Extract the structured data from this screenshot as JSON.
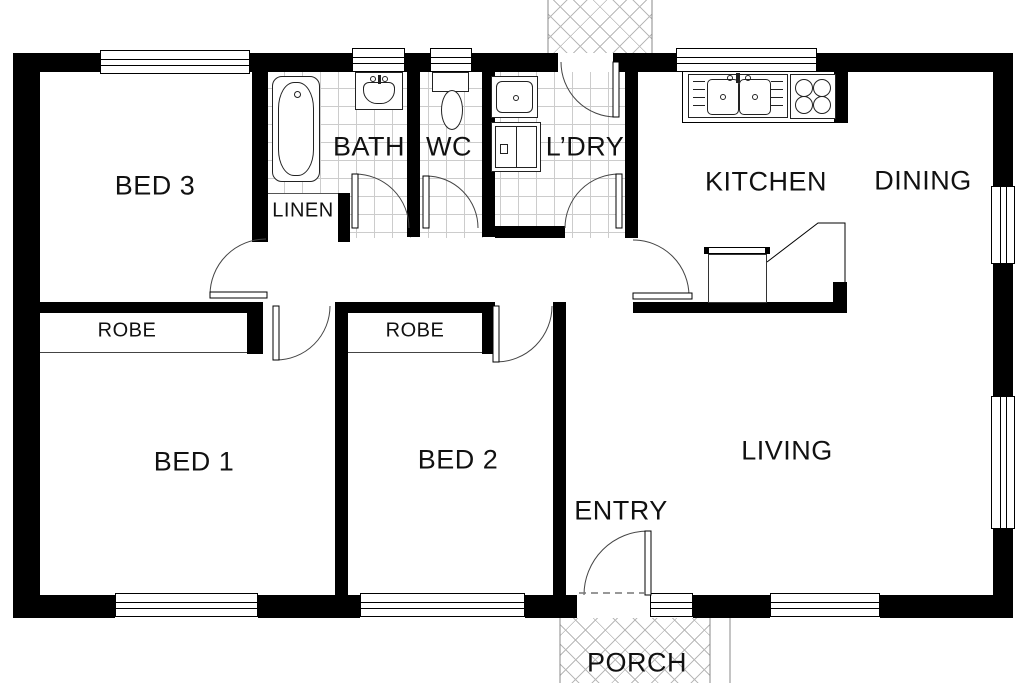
{
  "labels": {
    "bed3": "BED 3",
    "bath": "BATH",
    "wc": "WC",
    "ldry": "L’DRY",
    "kitchen": "KITCHEN",
    "dining": "DINING",
    "linen": "LINEN",
    "robe_bed1": "ROBE",
    "robe_bed2": "ROBE",
    "bed1": "BED 1",
    "bed2": "BED 2",
    "living": "LIVING",
    "entry": "ENTRY",
    "porch": "PORCH"
  },
  "colors": {
    "wall": "#000000",
    "floor": "#ffffff",
    "tile_line": "#cccccc",
    "hatch_line": "#b9b9b9"
  }
}
